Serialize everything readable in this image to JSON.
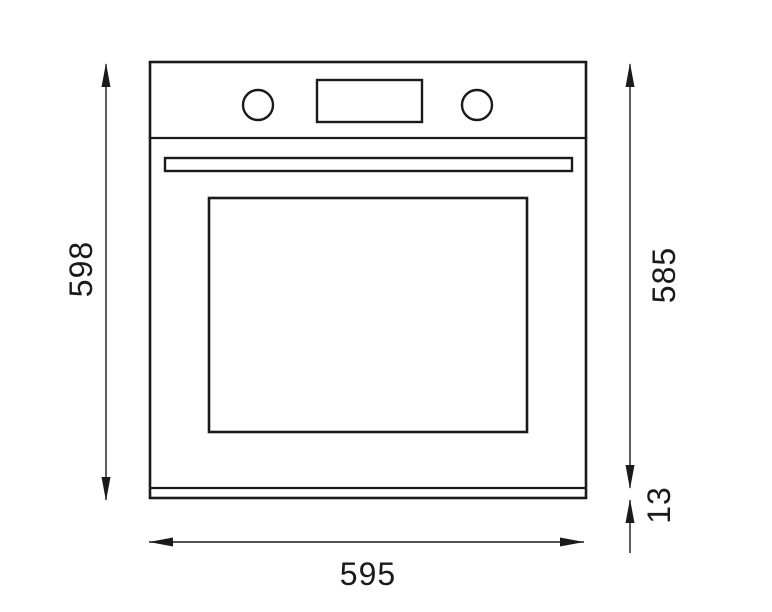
{
  "diagram": {
    "type": "technical-drawing",
    "subject": "built-in oven front elevation with installation dimensions",
    "background_color": "#ffffff",
    "line_color": "#1a1a1a",
    "oven": {
      "parts": [
        "control-panel",
        "left-control-knob",
        "display-window",
        "right-control-knob",
        "door-handle",
        "door-glass-window",
        "bottom-strip"
      ]
    },
    "dimensions": {
      "overall_height": {
        "value": "598",
        "orientation": "vertical",
        "side": "left"
      },
      "body_height": {
        "value": "585",
        "orientation": "vertical",
        "side": "right"
      },
      "strip_height": {
        "value": "13",
        "orientation": "vertical",
        "side": "right"
      },
      "overall_width": {
        "value": "595",
        "orientation": "horizontal",
        "side": "bottom"
      }
    }
  }
}
